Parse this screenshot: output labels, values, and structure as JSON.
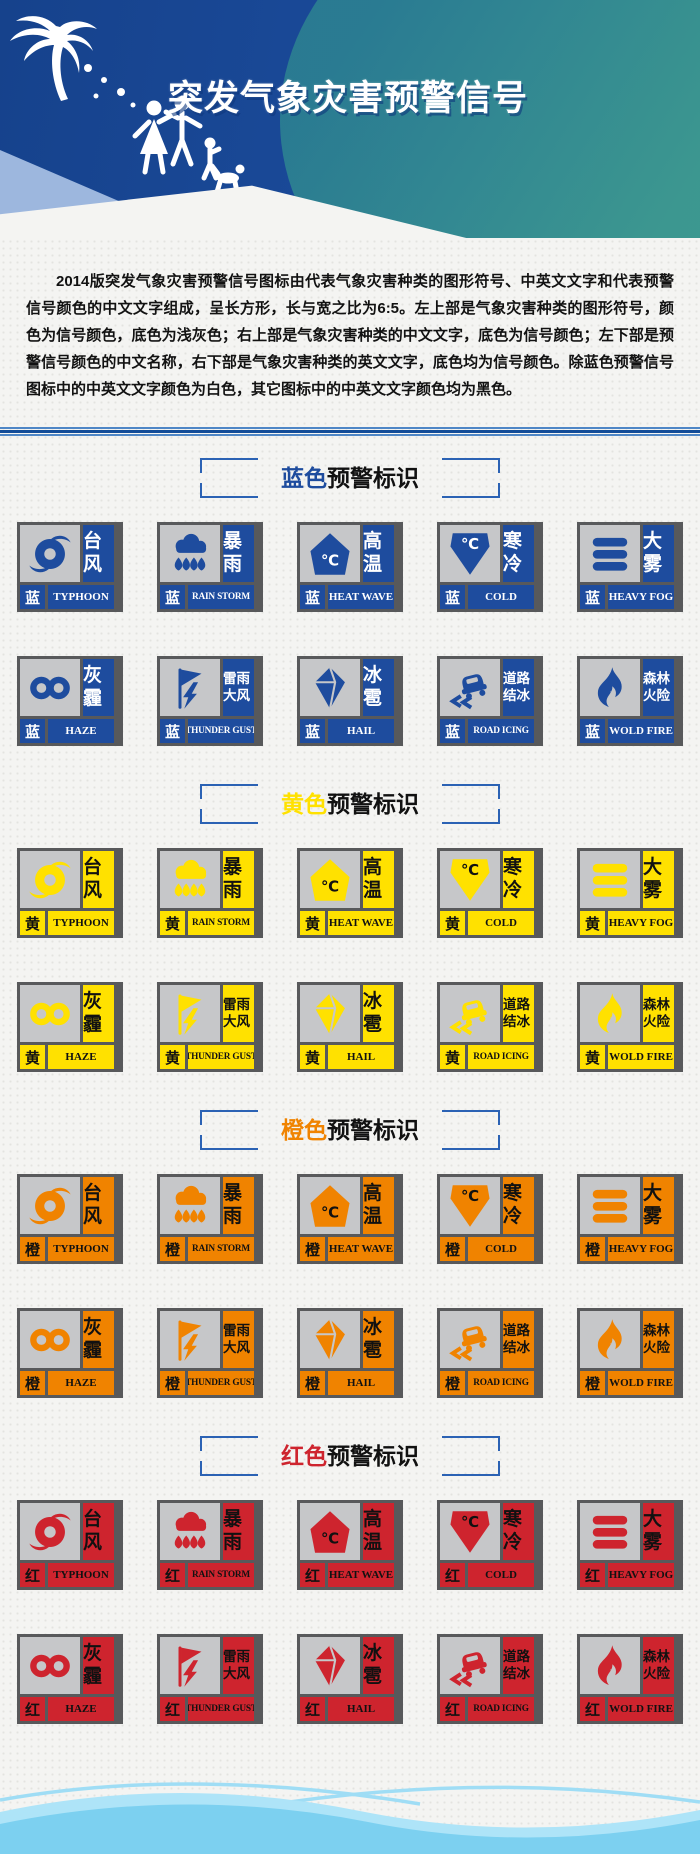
{
  "header": {
    "title": "突发气象灾害预警信号"
  },
  "intro": {
    "text": "2014版突发气象灾害预警信号图标由代表气象灾害种类的图形符号、中英文文字和代表预警信号颜色的中文文字组成，呈长方形，长与宽之比为6:5。左上部是气象灾害种类的图形符号，颜色为信号颜色，底色为浅灰色；右上部是气象灾害种类的中文文字，底色为信号颜色；左下部是预警信号颜色的中文名称，右下部是气象灾害种类的英文文字，底色均为信号颜色。除蓝色预警信号图标中的中英文文字颜色为白色，其它图标中的中英文文字颜色均为黑色。"
  },
  "sections": [
    {
      "id": "blue",
      "title_color_word": "蓝色",
      "title_suffix": "预警标识",
      "color_char": "蓝",
      "color": "#1E4C9E",
      "text_color": "#FFFFFF"
    },
    {
      "id": "yellow",
      "title_color_word": "黄色",
      "title_suffix": "预警标识",
      "color_char": "黄",
      "color": "#FFE100",
      "text_color": "#111111"
    },
    {
      "id": "orange",
      "title_color_word": "橙色",
      "title_suffix": "预警标识",
      "color_char": "橙",
      "color": "#F08300",
      "text_color": "#111111"
    },
    {
      "id": "red",
      "title_color_word": "红色",
      "title_suffix": "预警标识",
      "color_char": "红",
      "color": "#CE242E",
      "text_color": "#111111"
    }
  ],
  "warning_types": [
    {
      "id": "typhoon",
      "zh": "台风",
      "en": "TYPHOON",
      "icon": "typhoon-icon"
    },
    {
      "id": "rain-storm",
      "zh": "暴雨",
      "en": "RAIN STORM",
      "icon": "rain-storm-icon"
    },
    {
      "id": "heat-wave",
      "zh": "高温",
      "en": "HEAT WAVE",
      "icon": "heat-wave-icon"
    },
    {
      "id": "cold",
      "zh": "寒冷",
      "en": "COLD",
      "icon": "cold-icon"
    },
    {
      "id": "heavy-fog",
      "zh": "大雾",
      "en": "HEAVY FOG",
      "icon": "heavy-fog-icon"
    },
    {
      "id": "haze",
      "zh": "灰霾",
      "en": "HAZE",
      "icon": "haze-icon"
    },
    {
      "id": "thunder-gust",
      "zh": "雷雨大风",
      "en": "THUNDER GUST",
      "icon": "thunder-gust-icon"
    },
    {
      "id": "hail",
      "zh": "冰雹",
      "en": "HAIL",
      "icon": "hail-icon"
    },
    {
      "id": "road-icing",
      "zh": "道路结冰",
      "en": "ROAD ICING",
      "icon": "road-icing-icon"
    },
    {
      "id": "wold-fire",
      "zh": "森林火险",
      "en": "WOLD FIRE",
      "icon": "wold-fire-icon"
    }
  ],
  "colors": {
    "header_blue": "#1A4896",
    "header_teal": "#2F8694",
    "header_light_band": "#9DB7DE",
    "signal_blue": "#1E4C9E",
    "signal_yellow": "#FFE100",
    "signal_orange": "#F08300",
    "signal_red": "#CE242E",
    "icon_bg_gray": "#C6C7C9",
    "frame_gray": "#58595B",
    "bracket_blue": "#2B62B4",
    "divider_blue": "#124C98",
    "footer_wave_light": "#AEE4F8",
    "footer_wave_deep": "#7CD0F0"
  }
}
